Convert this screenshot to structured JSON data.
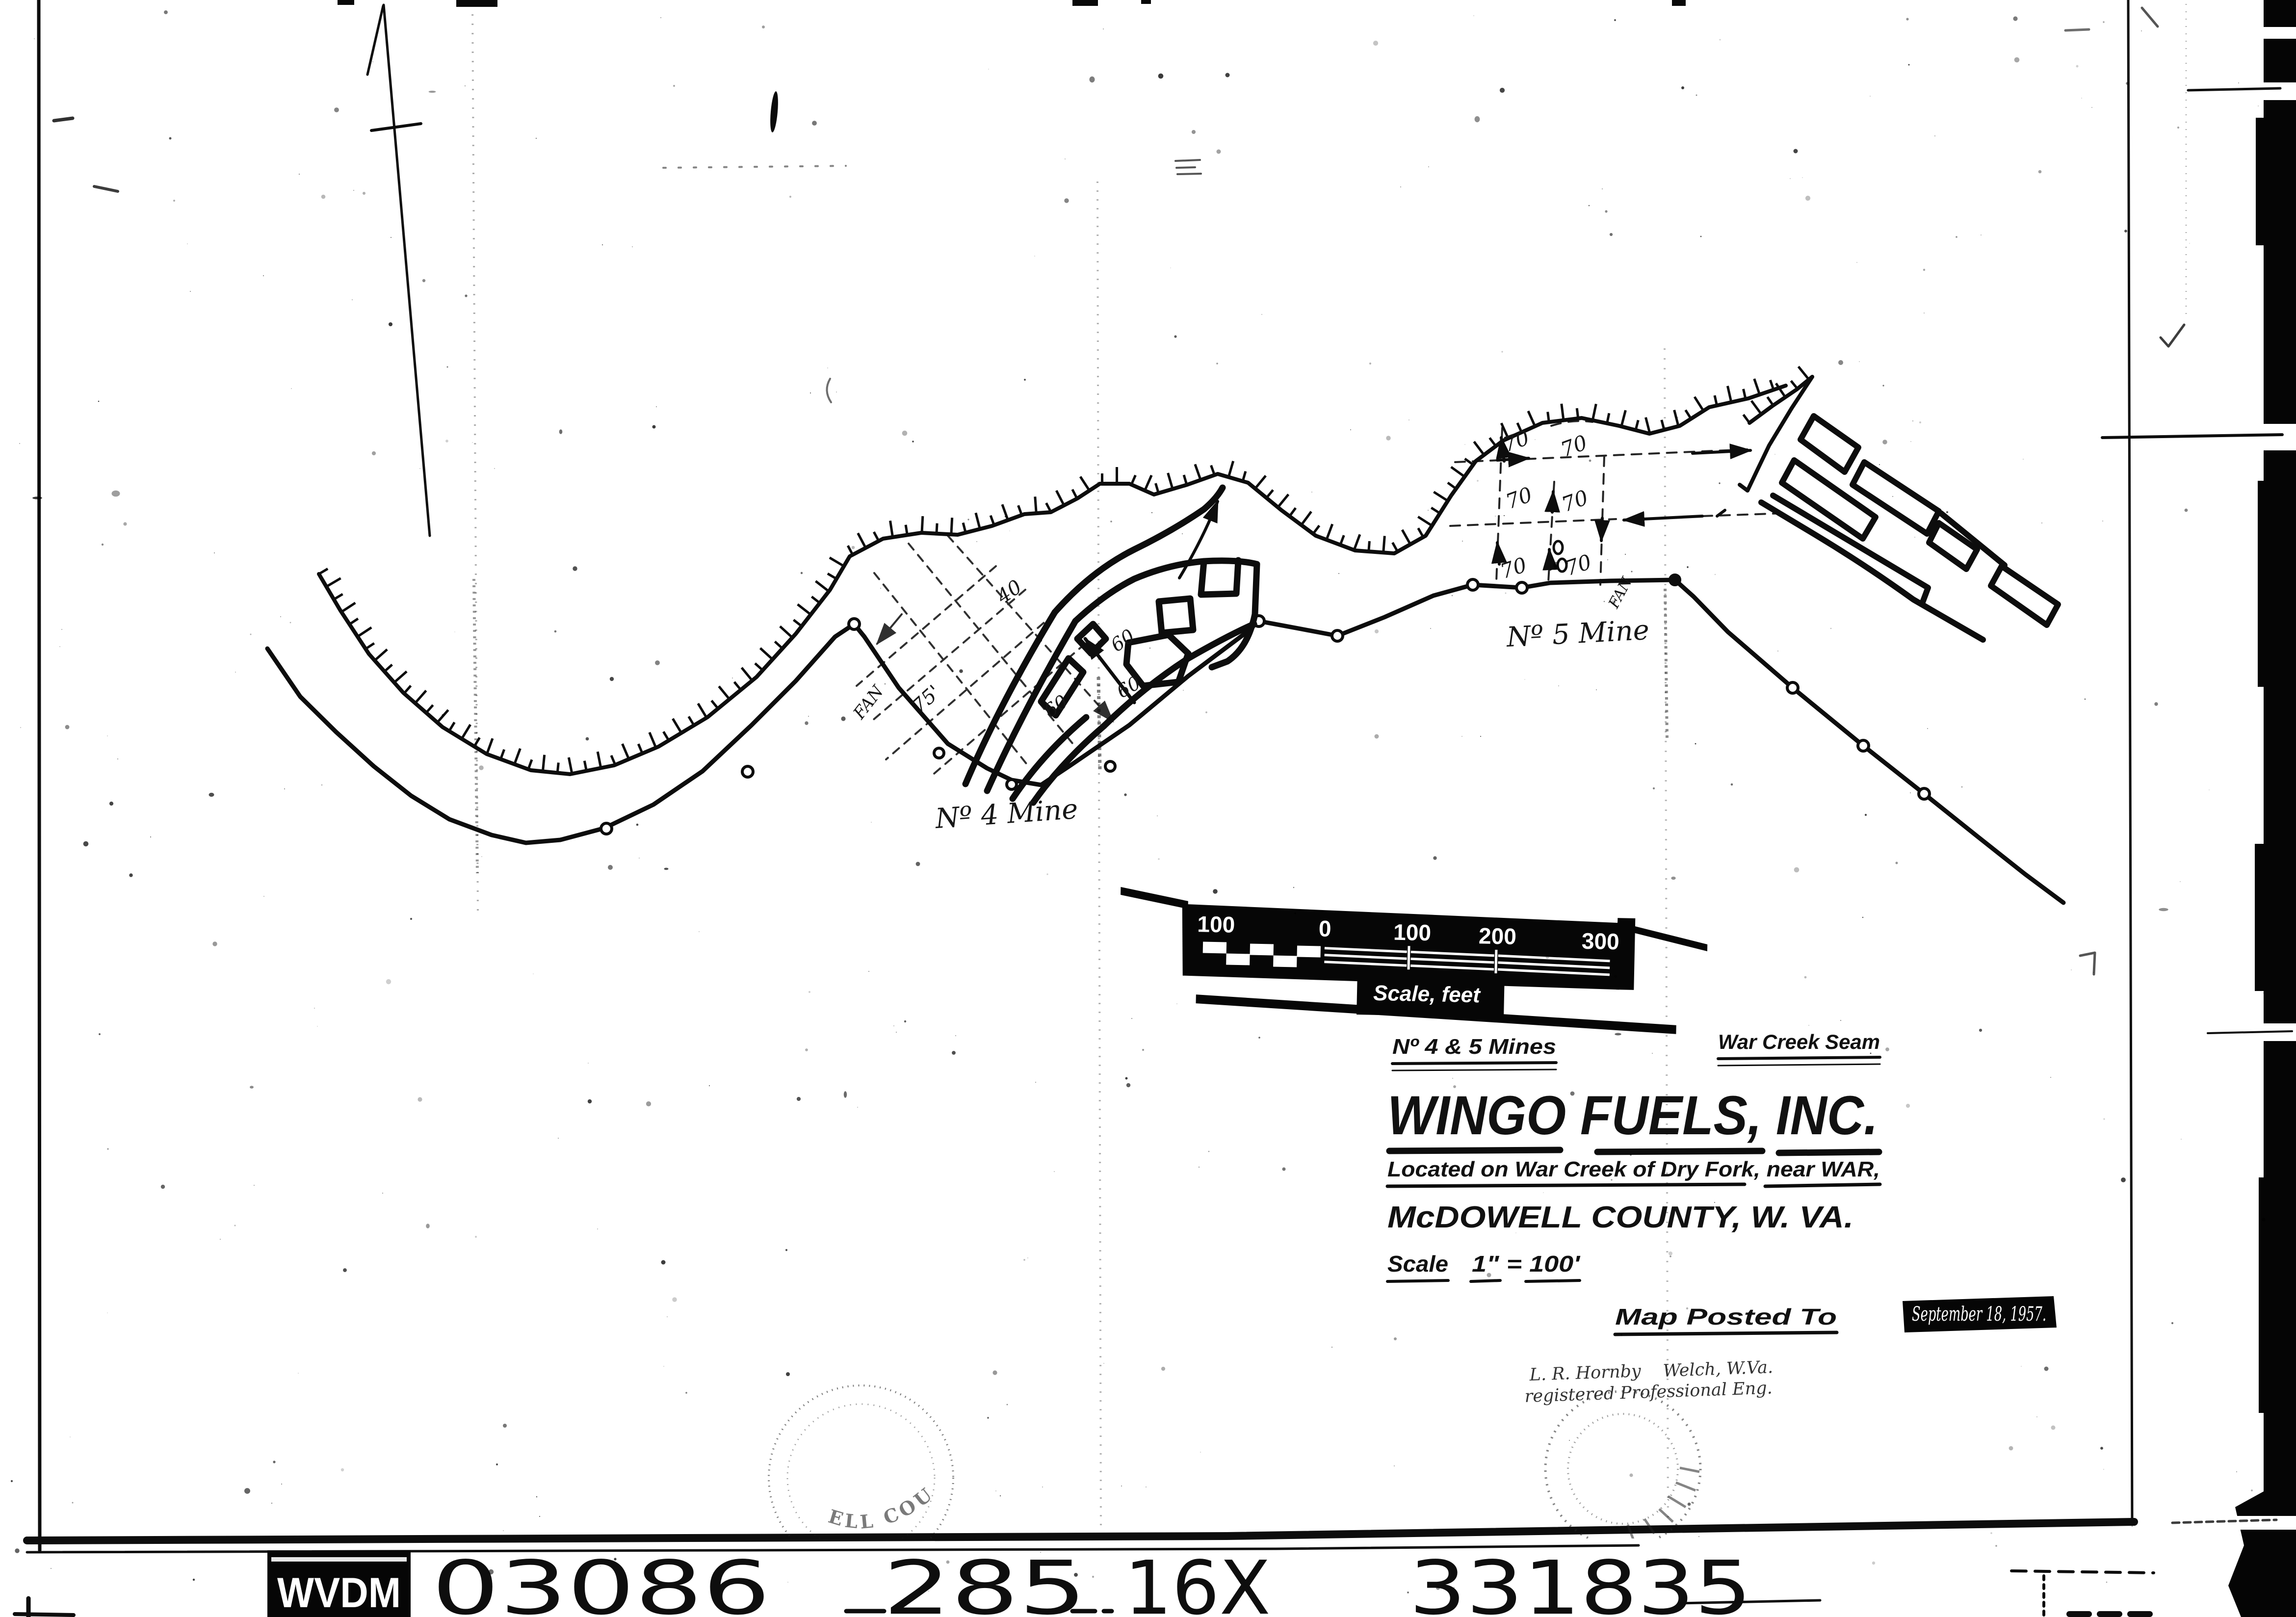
{
  "document": {
    "header_left": "Nº 4 & 5 Mines",
    "header_right": "War Creek Seam",
    "title": "WINGO  FUELS, INC.",
    "location_line": "Located on War Creek of Dry Fork,  near WAR,",
    "county_line": "McDOWELL COUNTY,  W. VA.",
    "scale_label": "Scale",
    "scale_value": "1\" = 100'",
    "posted_label": "Map Posted To",
    "posted_value": "September 18, 1957.",
    "engineer_name": "L. R. Hornby",
    "engineer_place": "Welch, W.Va.",
    "engineer_title": "registered Professional Eng."
  },
  "map": {
    "mine4_label": "Nº 4 Mine",
    "mine5_label": "Nº 5 Mine",
    "fan_label_4": "FAN",
    "fan_label_5": "FAN",
    "dim_75": "75'",
    "dim_40": "40",
    "dims_60": [
      "60",
      "60",
      "60"
    ],
    "dims_70": [
      "70",
      "70",
      "70",
      "70",
      "70",
      "70"
    ],
    "scale_bar": {
      "ticks": [
        "100",
        "0",
        "100",
        "200",
        "300"
      ],
      "caption": "Scale, feet"
    },
    "seal_left_text": "ELL COUNTY"
  },
  "film_strip": {
    "badge": "WVDM",
    "numbers": [
      "03086",
      "285",
      "16X",
      "331835"
    ]
  },
  "colors": {
    "ink": "#0d0d0d",
    "paper": "#ffffff"
  }
}
